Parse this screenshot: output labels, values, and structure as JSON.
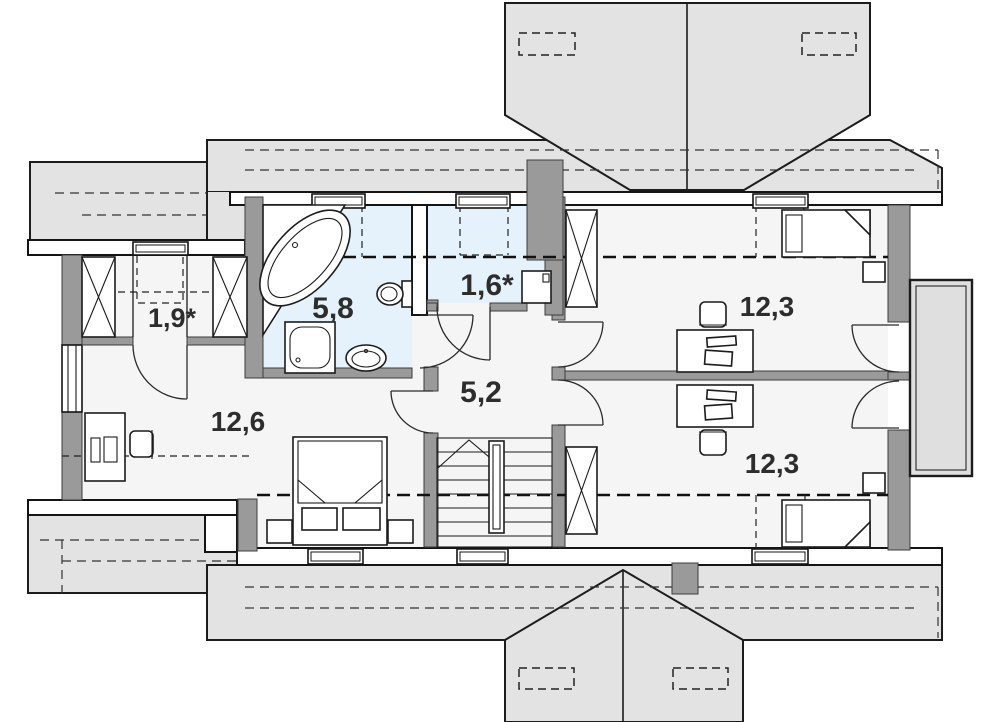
{
  "plan": {
    "type": "floor-plan-attic",
    "rooms": [
      {
        "name": "closet",
        "label": "1,9*"
      },
      {
        "name": "bathroom",
        "label": "5,8"
      },
      {
        "name": "utility",
        "label": "1,6*"
      },
      {
        "name": "hall",
        "label": "5,2"
      },
      {
        "name": "bedroom-left",
        "label": "12,6"
      },
      {
        "name": "bedroom-right-top",
        "label": "12,3"
      },
      {
        "name": "bedroom-right-bottom",
        "label": "12,3"
      }
    ],
    "colors": {
      "roof": "#e3e3e3",
      "wall": "#9a9a9a",
      "wet": "#e6f2fb",
      "floor": "#f5f5f5",
      "balcony": "#dfdfdf"
    }
  }
}
